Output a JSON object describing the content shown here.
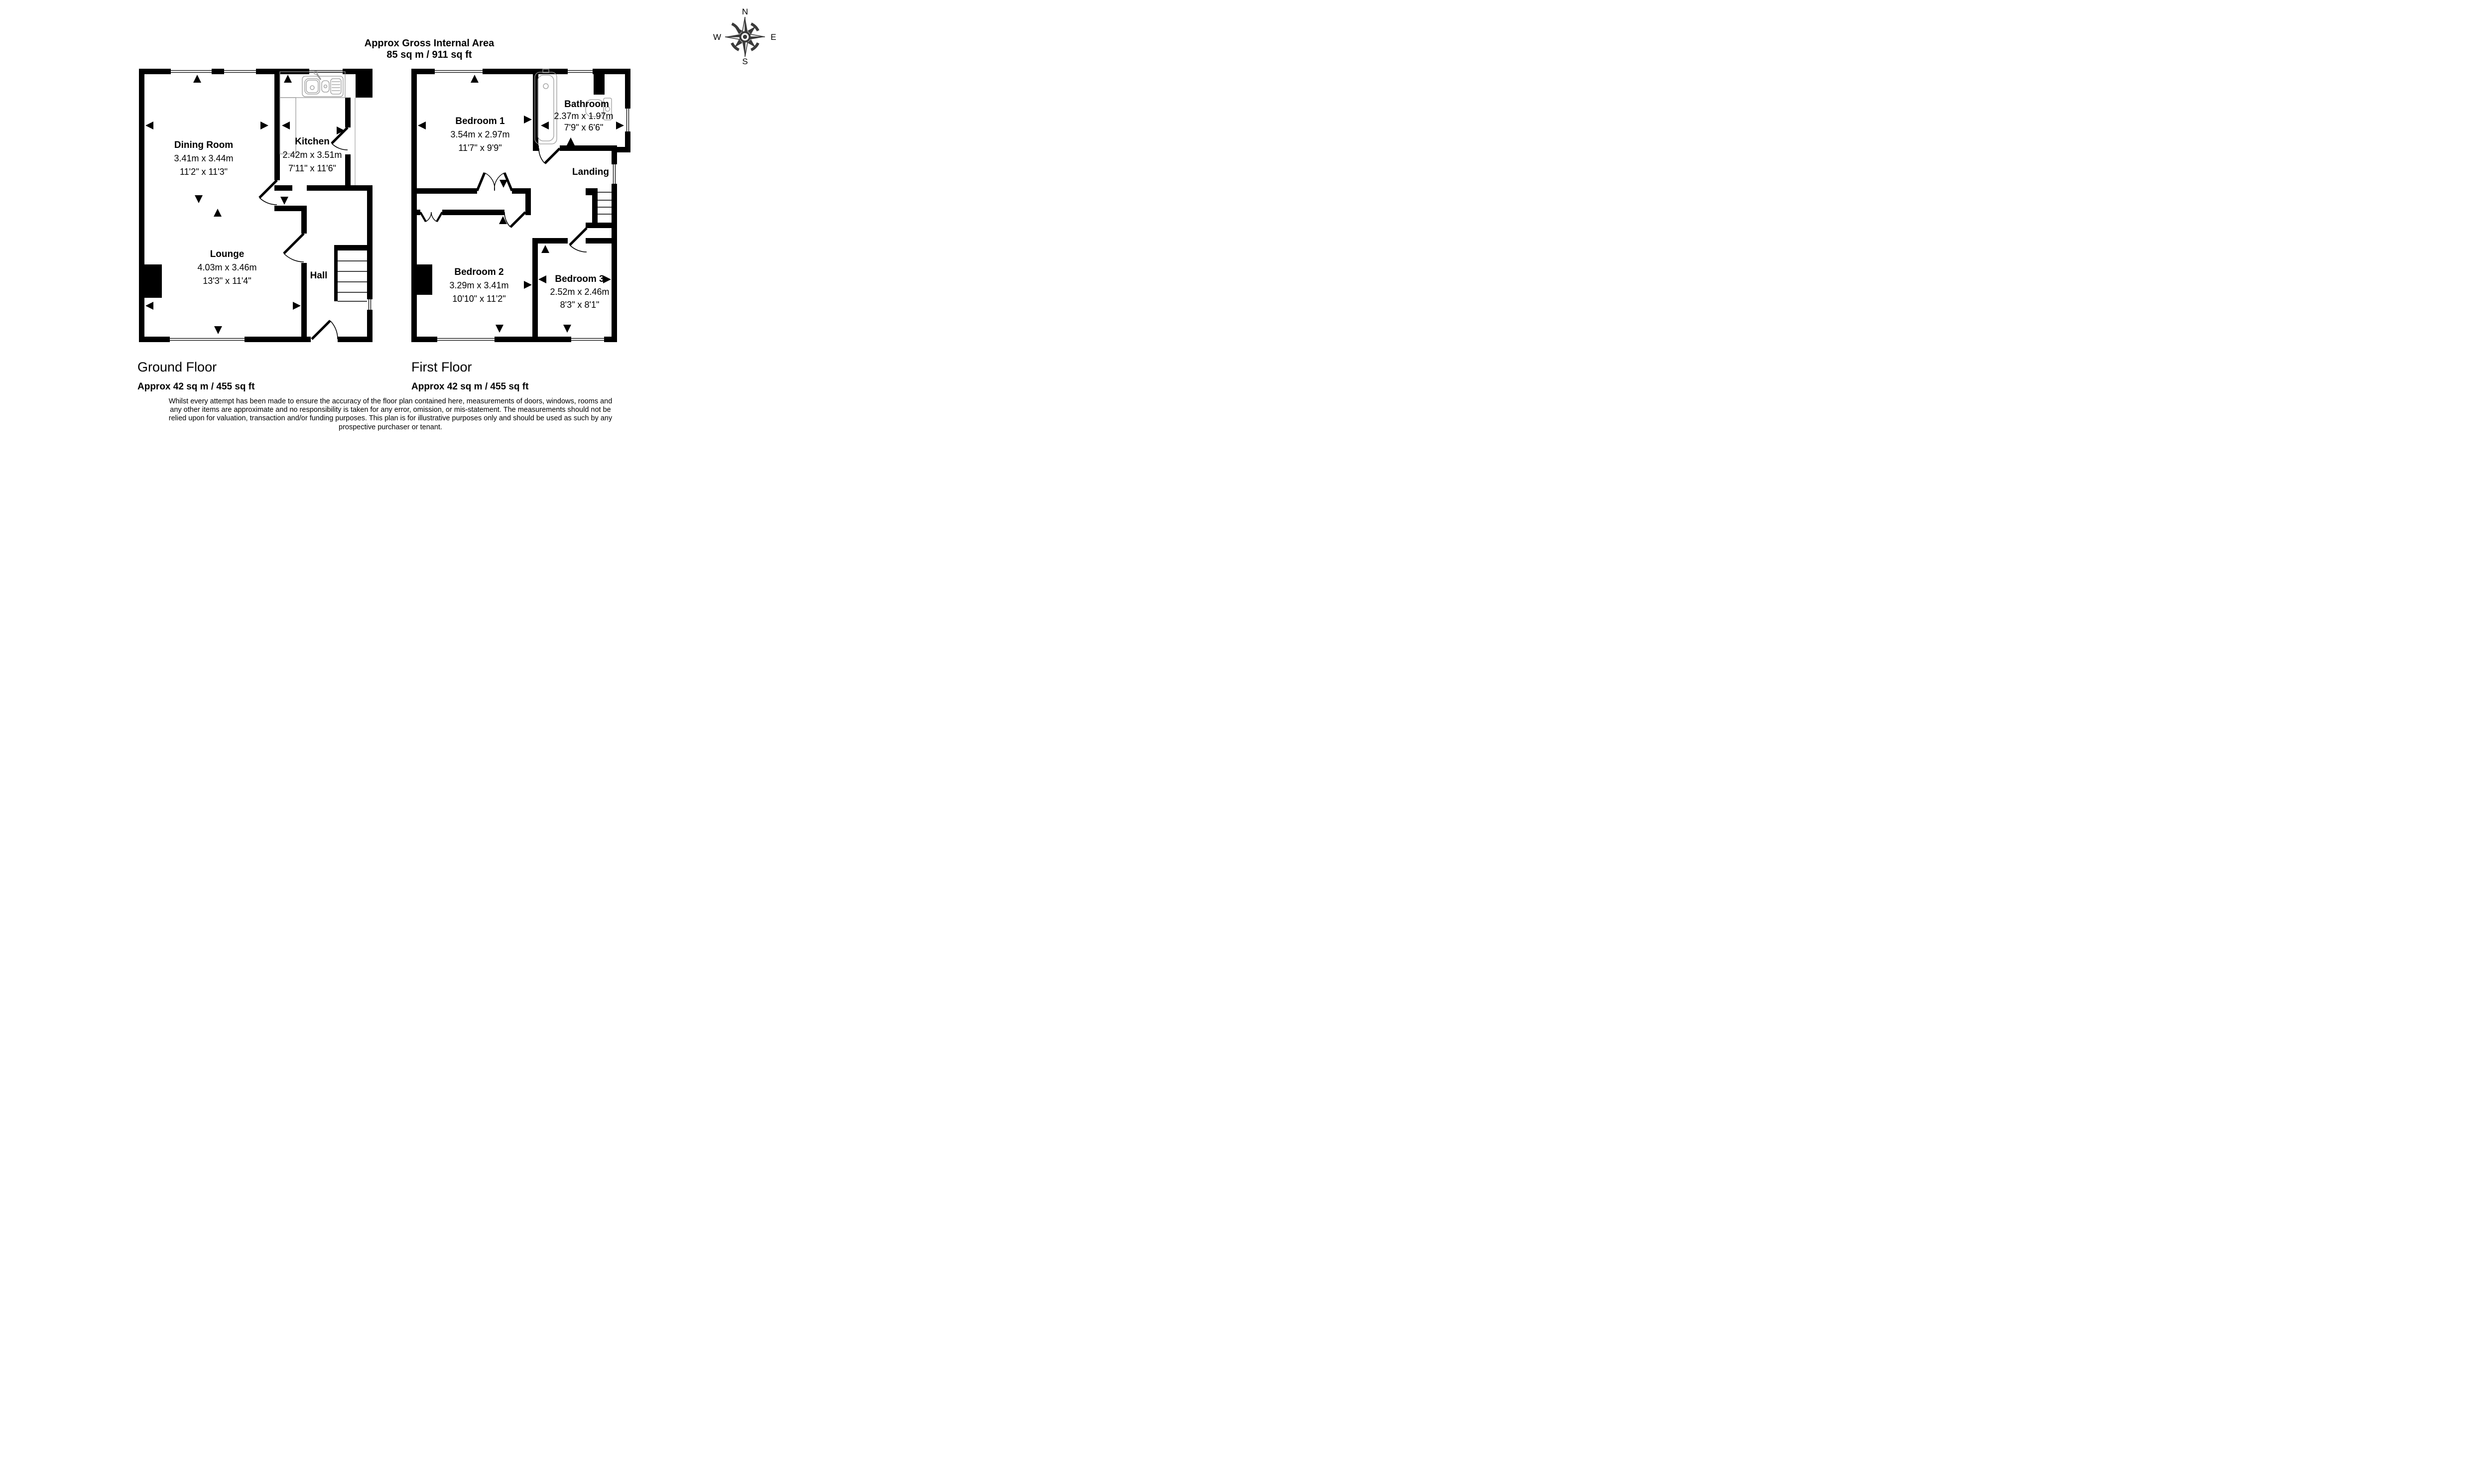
{
  "title": {
    "line1": "Approx Gross Internal Area",
    "line2": "85 sq m / 911 sq ft"
  },
  "compass": {
    "n": "N",
    "e": "E",
    "s": "S",
    "w": "W"
  },
  "ground": {
    "caption": "Ground Floor",
    "area": "Approx 42 sq m / 455 sq ft",
    "rooms": [
      {
        "name": "Dining Room",
        "metric": "3.41m x 3.44m",
        "imperial": "11'2\" x 11'3\""
      },
      {
        "name": "Kitchen",
        "metric": "2.42m x 3.51m",
        "imperial": "7'11\" x 11'6\""
      },
      {
        "name": "Lounge",
        "metric": "4.03m x 3.46m",
        "imperial": "13'3\" x 11'4\""
      },
      {
        "name": "Hall"
      }
    ]
  },
  "first": {
    "caption": "First Floor",
    "area": "Approx 42 sq m / 455 sq ft",
    "rooms": [
      {
        "name": "Bedroom 1",
        "metric": "3.54m x 2.97m",
        "imperial": "11'7\" x 9'9\""
      },
      {
        "name": "Bathroom",
        "metric": "2.37m x 1.97m",
        "imperial": "7'9\" x 6'6\""
      },
      {
        "name": "Landing"
      },
      {
        "name": "Bedroom 2",
        "metric": "3.29m x 3.41m",
        "imperial": "10'10\" x 11'2\""
      },
      {
        "name": "Bedroom 3",
        "metric": "2.52m x 2.46m",
        "imperial": "8'3\" x 8'1\""
      }
    ]
  },
  "disclaimer": {
    "lines": [
      "Whilst every attempt has been made to ensure the accuracy of the floor plan contained here, measurements of doors, windows, rooms and",
      "any other items are approximate and no responsibility is taken for any error, omission, or mis-statement. The measurements should not be",
      "relied upon for valuation, transaction and/or funding purposes. This plan is for illustrative purposes only and should be used as such by any",
      "prospective purchaser or tenant."
    ]
  }
}
